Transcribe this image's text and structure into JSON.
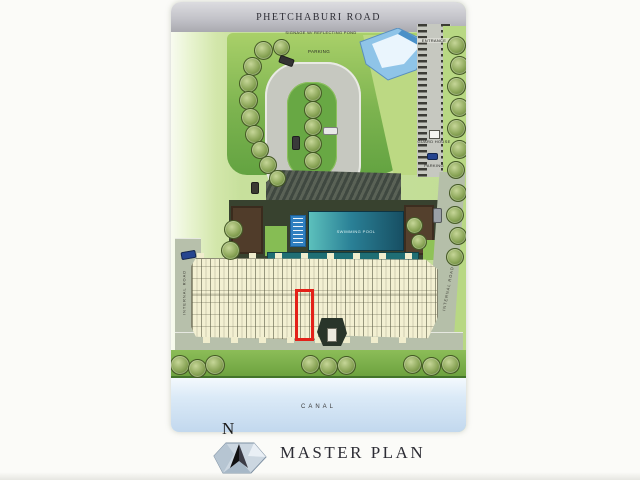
{
  "page": {
    "title": "MASTER PLAN",
    "north_label": "N"
  },
  "plan": {
    "top_road_label": "PHETCHABURI ROAD",
    "signage_label": "SIGNAGE W/ REFLECTING POND",
    "parking_label_top": "PARKING",
    "entrance_label": "ENTRANCE",
    "guard_house_label": "GUARD HOUSE",
    "parking_label_right": "PARKING",
    "pool_label": "SWIMMING POOL",
    "internal_road_label_left": "INTERNAL ROAD",
    "internal_road_label_right": "INTERNAL ROAD",
    "canal_label": "CANAL"
  },
  "colors": {
    "highlight_red": "#e32119",
    "pool_teal": "#2a8096",
    "canal_blue": "#c2d8ee",
    "lawn_green": "#68a844",
    "road_gray": "#c6c8c0",
    "building_cream": "#f3f0d2"
  }
}
